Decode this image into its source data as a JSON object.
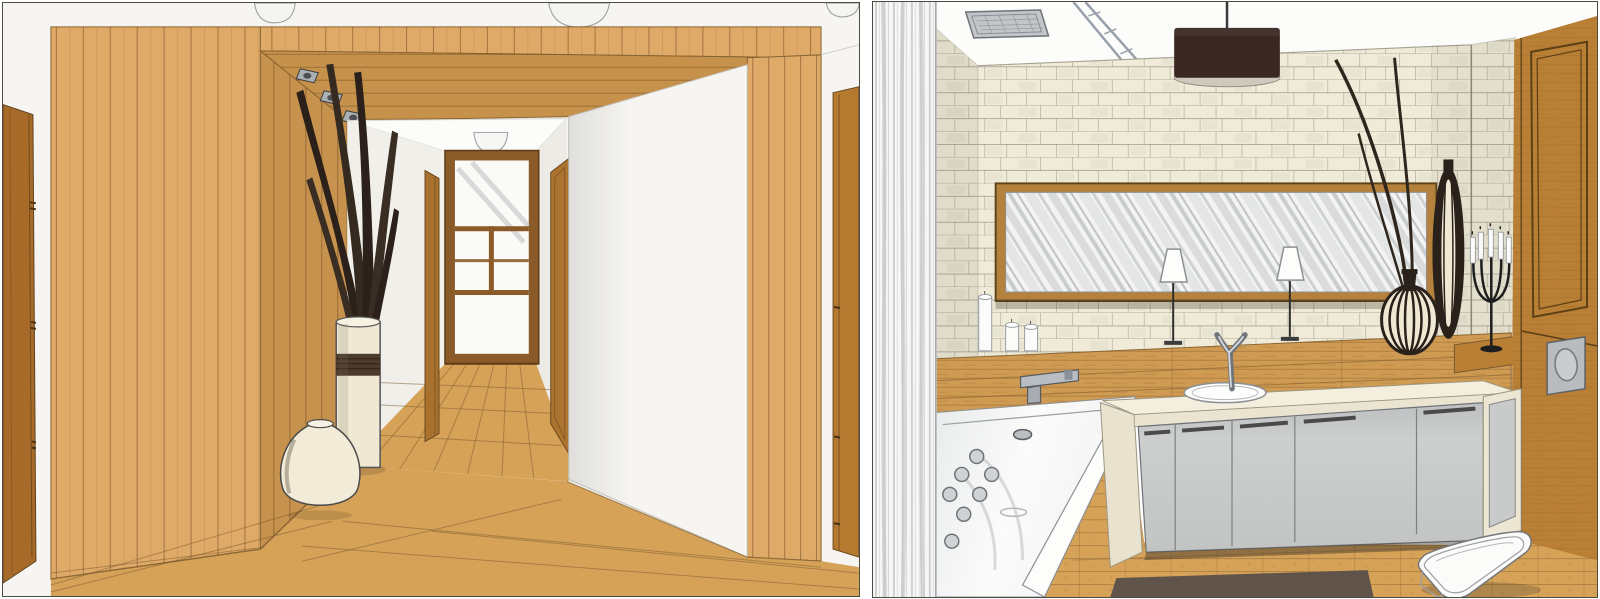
{
  "page": {
    "title": "Interior design hand-drawn renderings",
    "description": "Two colored-pencil interior renderings side by side: a wood-panelled hallway and a stone-walled bathroom."
  },
  "panels": [
    {
      "id": "hallway",
      "label": "Hallway rendering with wood-panelled walls",
      "objects": {
        "left_door": "wooden door, partially visible at left edge",
        "wood_wall": "vertical plank wood wall",
        "ceiling_lights": "sketched ceiling light fixtures at top edge",
        "soffit_spotlights": "three recessed spotlights in wooden soffit",
        "tall_vase": "white cylinder vase with rope band holding dried leaves",
        "round_vase": "round cream ceramic vase",
        "glazed_door": "wood-framed glazed door at end of hallway",
        "hall_ceiling_light": "half-dome ceiling lamp in hallway",
        "side_door": "wooden side door on right hallway wall",
        "narrow_door": "edge-on door on left hallway wall",
        "white_wall": "large white wall volume right of hallway",
        "right_door": "wooden door partially visible at right edge",
        "floor": "wood plank flooring"
      }
    },
    {
      "id": "bathroom",
      "label": "Bathroom rendering with stacked-stone wall",
      "objects": {
        "curtain": "sheer curtain at left edge",
        "ceiling_vent": "square recessed ceiling fixture",
        "ceiling_beam": "diagonal ceiling support",
        "pendant_lamp": "dark brown drum pendant light",
        "stone_wall": "cream stacked-stone wall",
        "mirror": "wide wood-framed mirror with diagonal reflections",
        "table_lamps": "two small cone-shade table lamps",
        "candles": "three white pillar candles",
        "wood_ledge": "wooden shelf and backsplash band",
        "tub_faucet": "wall-mounted chrome tub spout",
        "bathtub": "white whirlpool bathtub with jets",
        "sink_faucet": "chrome Y-shaped basin tap",
        "sink": "oval inset basin",
        "vanity": "stone-topped vanity with grey cabinet doors",
        "rug": "dark brown rug",
        "toilet": "white wall-hung toilet",
        "flush_plate": "grey flush plate on wood wall",
        "candelabra": "black five-arm candelabra with white candles",
        "onion_vase": "ribbed onion-shaped vase with tall reed stems",
        "slender_vase": "tall slender ribbed vase",
        "wood_door": "wooden door on right wall",
        "floor": "wood floor"
      }
    }
  ],
  "colors": {
    "canvas": "#ffffff",
    "panel_border": "#4f4a43",
    "wall_white": "#f6f5f1",
    "ceiling_white": "#fcfcfa",
    "wood_light": "#dfa967",
    "wood_mid": "#cf9a52",
    "wood_dark": "#b97f35",
    "wood_door": "#a86a28",
    "wood_door_light": "#b5792f",
    "wood_floor": "#d6a258",
    "line_brown": "#7a5a2e",
    "stone_cream": "#f0ebd9",
    "stone_shadow": "#e5dfc9",
    "stone_line": "#8f8b7a",
    "pencil": "#9aa0a6",
    "cabinet_gray": "#c9cbcc",
    "counter_cream": "#f3eedd",
    "rug_brown": "#60544a",
    "fixture_white": "#fbfbfa",
    "dark_brown": "#3a2722",
    "near_black": "#2b211b",
    "cream_object": "#efe9d4",
    "chrome": "#8a9097"
  }
}
